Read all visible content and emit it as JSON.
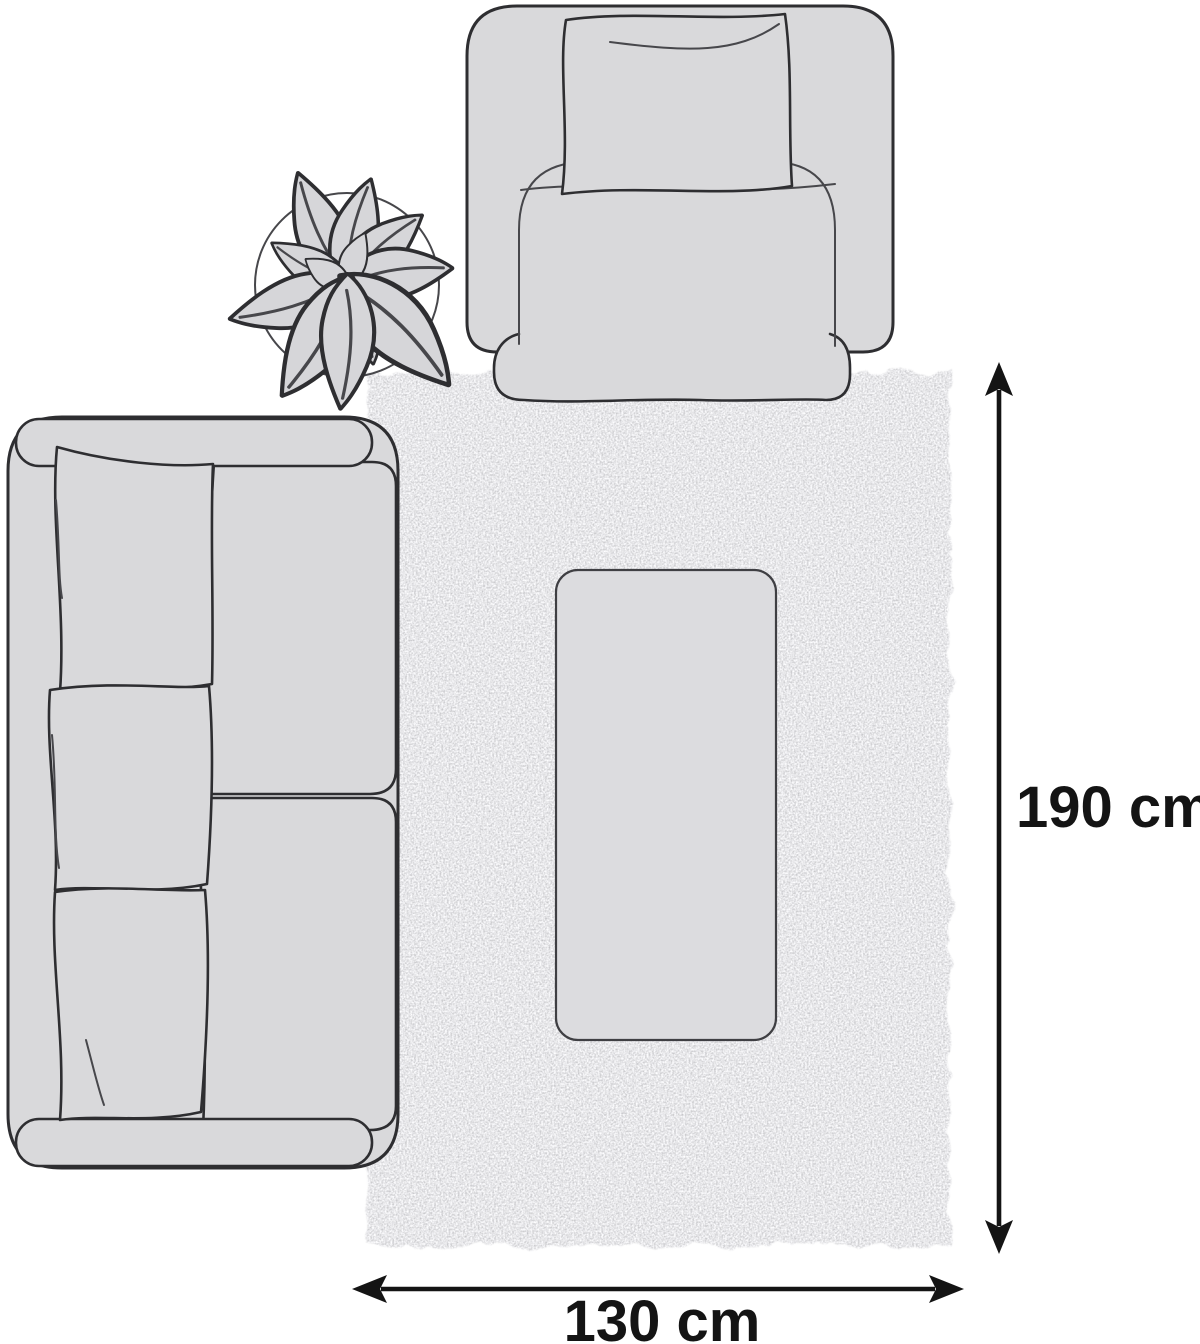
{
  "diagram": {
    "kind": "rug-size-top-view-illustration",
    "labels": {
      "height": "190 cm",
      "width": "130 cm"
    },
    "dimensions_cm": {
      "height": 190,
      "width": 130
    },
    "scene_objects": [
      "sofa",
      "armchair",
      "potted-plant",
      "rug",
      "coffee-table"
    ],
    "colors": {
      "background": "#ffffff",
      "furniture_fill": "#d9d9db",
      "table_fill": "#dcdcdf",
      "plant_fill": "#d6d6d9",
      "rug_base": "#cbcbce",
      "outline": "#2e2e31",
      "arrow": "#141414"
    }
  }
}
